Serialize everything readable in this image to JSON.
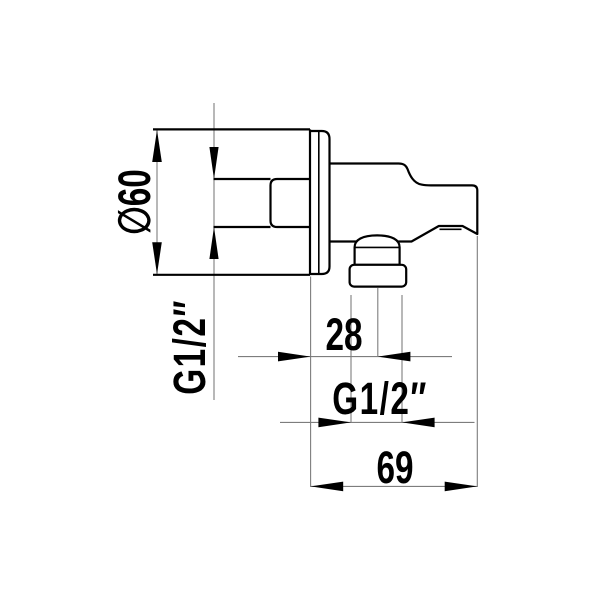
{
  "drawing": {
    "kind": "technical-dimension-drawing",
    "colors": {
      "background": "#ffffff",
      "outline": "#000000",
      "dimension_line": "#7d7d7d",
      "text": "#000000"
    },
    "labels": {
      "plate_diameter": "∅60",
      "wall_thread": "G1/2″",
      "outlet_offset": "28",
      "outlet_thread": "G1/2″",
      "overall_depth": "69"
    }
  }
}
